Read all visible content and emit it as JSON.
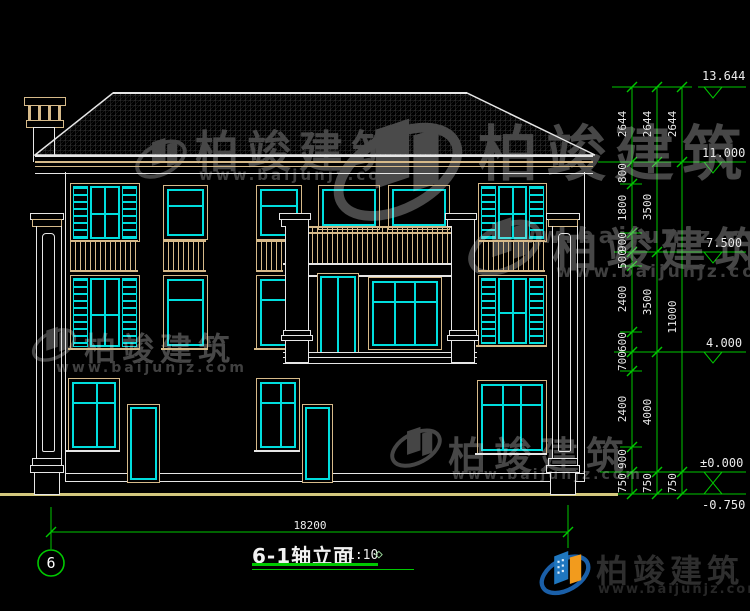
{
  "title": {
    "name": "6-1轴立面",
    "scale": "1:10"
  },
  "axis_bubble": "6",
  "bottom_dim": "18200",
  "levels": [
    "13.644",
    "11.000",
    "7.500",
    "4.000",
    "±0.000",
    "-0.750"
  ],
  "dims": {
    "chain1": [
      "2644",
      "800",
      "1800",
      "900",
      "500",
      "2400",
      "600",
      "700",
      "2400",
      "900",
      "750"
    ],
    "chain2": [
      "2644",
      "3500",
      "3500",
      "4000",
      "750"
    ],
    "chain3": [
      "2644",
      "11000",
      "750"
    ]
  },
  "watermark": {
    "brand": "柏竣建筑",
    "url": "www.baijunjz.com"
  },
  "colors": {
    "dim_green": "#00c800",
    "cad_white": "#e6e6e6",
    "wood_tan": "#d6ba8a",
    "glazing_cyan": "#00dede",
    "ground_khaki": "#d4c87e",
    "logo_blue": "#1f77c0",
    "logo_orange": "#f29b1d"
  }
}
